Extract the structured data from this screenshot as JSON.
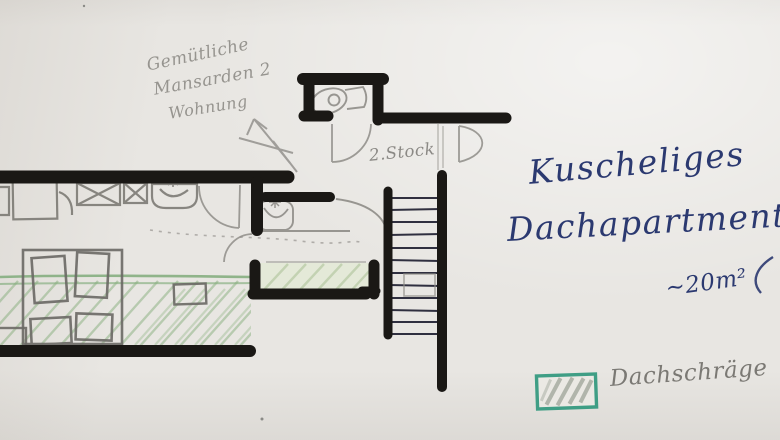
{
  "sketch": {
    "pencil_note": {
      "line1": "Gemütliche",
      "line2": "Mansarden 2",
      "line3": "Wohnung"
    },
    "floor_label": "2.Stock",
    "title": {
      "line1": "Kuscheliges",
      "line2": "Dachapartment",
      "area": "~20m²"
    },
    "legend": {
      "label": "Dachschräge",
      "swatch": "green-diagonal-hatch"
    },
    "colors": {
      "paper": "#e8e6e2",
      "marker_black": "#1a1815",
      "pencil_gray": "#8f8d88",
      "ink_blue": "#2b3970",
      "hatch_green": "#86ae7c",
      "legend_teal": "#3f9e85"
    }
  }
}
